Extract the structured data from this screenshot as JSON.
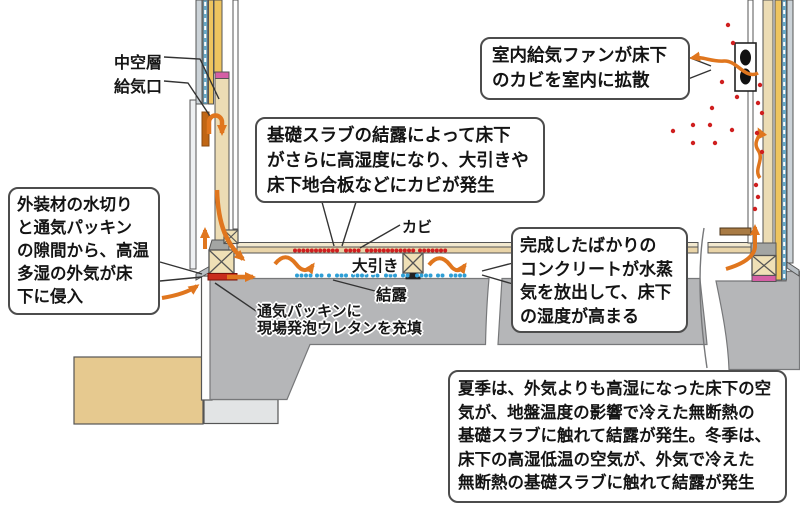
{
  "diagram_title": "basement-moisture-condensation-section",
  "labels": {
    "hollow_layer": "中空層",
    "air_inlet": "給気口",
    "mold": "カビ",
    "girder": "大引き",
    "condensation": "結露",
    "packing_note": {
      "lines": [
        "通気パッキンに",
        "現場発泡ウレタンを充填"
      ]
    }
  },
  "callouts": {
    "exterior_air": {
      "lines": [
        "外装材の水切り",
        "と通気パッキン",
        "の隙間から、高温",
        "多湿の外気が床",
        "下に侵入"
      ]
    },
    "slab_condensation": {
      "lines": [
        "基礎スラブの結露によって床下",
        "がさらに高湿度になり、大引きや",
        "床下地合板などにカビが発生"
      ]
    },
    "supply_fan": {
      "lines": [
        "室内給気ファンが床下",
        "のカビを室内に拡散"
      ]
    },
    "fresh_concrete": {
      "lines": [
        "完成したばかりの",
        "コンクリートが水蒸",
        "気を放出して、床下",
        "の湿度が高まる"
      ]
    },
    "season_note": {
      "lines": [
        "夏季は、外気よりも高湿になった床下の空",
        "気が、地盤温度の影響で冷えた無断熱の",
        "基礎スラブに触れて結露が発生。冬季は、",
        "床下の高湿低温の空気が、外気で冷えた",
        "無断熱の基礎スラブに触れて結露が発生"
      ]
    }
  },
  "colors": {
    "arrow_orange": "#e0761e",
    "mold_red": "#cf1f1f",
    "condensation_blue": "#2e9fd6",
    "packing_pink": "#d55fa5",
    "vent_packing_red": "#c92d1c",
    "slab_gray": "#b5b6b8",
    "wood_tan": "#ecdcb4",
    "insulation_yellow": "#eec45f",
    "soil_tan": "#e6c98f",
    "inlet_dark_orange": "#c06614"
  },
  "decor": {
    "mold_dots": {
      "color": "#cf1f1f",
      "y": 250.5,
      "r": 2,
      "groups": [
        {
          "x": 295,
          "count": 11,
          "step": 4.2
        },
        {
          "x": 346,
          "count": 4,
          "step": 4.2
        },
        {
          "x": 367,
          "count": 12,
          "step": 4.2
        },
        {
          "x": 420,
          "count": 7,
          "step": 4.2
        }
      ]
    },
    "condensation_dots": {
      "color": "#2e9fd6",
      "y": 275.5,
      "r": 2,
      "groups": [
        {
          "x": 297,
          "count": 4,
          "step": 4.5
        },
        {
          "x": 317,
          "count": 2,
          "step": 4.5
        },
        {
          "x": 329,
          "count": 1,
          "step": 4.5
        },
        {
          "x": 337,
          "count": 3,
          "step": 4.5
        },
        {
          "x": 353,
          "count": 4,
          "step": 4.5
        },
        {
          "x": 373,
          "count": 2,
          "step": 4.5
        },
        {
          "x": 386,
          "count": 3,
          "step": 4.5
        },
        {
          "x": 403,
          "count": 2,
          "step": 4.5
        },
        {
          "x": 417,
          "count": 4,
          "step": 4.5
        },
        {
          "x": 438,
          "count": 2,
          "step": 4.5
        },
        {
          "x": 451,
          "count": 4,
          "step": 4.5
        }
      ]
    },
    "spores": {
      "color": "#cf1f1f",
      "r": 2.2,
      "points": [
        [
          728,
          25
        ],
        [
          733,
          43
        ],
        [
          760,
          85
        ],
        [
          722,
          82
        ],
        [
          737,
          97
        ],
        [
          712,
          108
        ],
        [
          758,
          103
        ],
        [
          762,
          113
        ],
        [
          693,
          125
        ],
        [
          710,
          125
        ],
        [
          732,
          130
        ],
        [
          673,
          131
        ],
        [
          757,
          133
        ],
        [
          693,
          143
        ],
        [
          715,
          143
        ],
        [
          762,
          152
        ],
        [
          756,
          185
        ],
        [
          758,
          197
        ],
        [
          755,
          209
        ]
      ]
    }
  }
}
